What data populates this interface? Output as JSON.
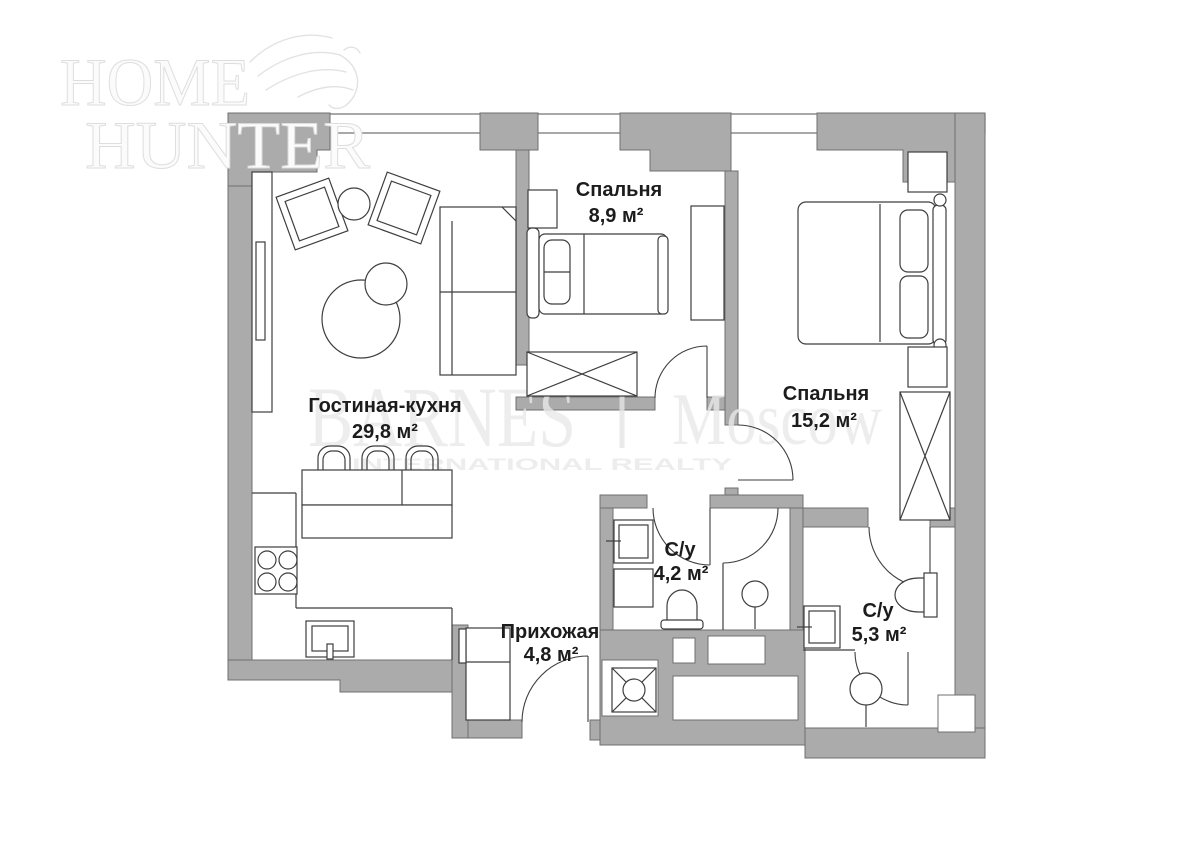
{
  "watermarks": {
    "home_hunter": {
      "line1": "HOME",
      "line2": "HUNTER"
    },
    "agency": {
      "brand": "BARNES",
      "separator": "|",
      "city": "Moscow",
      "tagline": "INTERNATIONAL REALTY"
    }
  },
  "rooms": [
    {
      "id": "living-kitchen",
      "name": "Гостиная-кухня",
      "area": "29,8 м²"
    },
    {
      "id": "bedroom-1",
      "name": "Спальня",
      "area": "8,9 м²"
    },
    {
      "id": "bedroom-2",
      "name": "Спальня",
      "area": "15,2 м²"
    },
    {
      "id": "bathroom-1",
      "name": "С/у",
      "area": "4,2 м²"
    },
    {
      "id": "bathroom-2",
      "name": "С/у",
      "area": "5,3 м²"
    },
    {
      "id": "hallway",
      "name": "Прихожая",
      "area": "4,8 м²"
    }
  ],
  "colors": {
    "background": "#ffffff",
    "wall": "#ababab",
    "wall_outline": "#6f6f6f",
    "furniture_line": "#3e3e3e",
    "label_text": "#1c1c1c",
    "watermark_gray": "#e9e9e9",
    "watermark_emboss": "#e0e0e0"
  }
}
